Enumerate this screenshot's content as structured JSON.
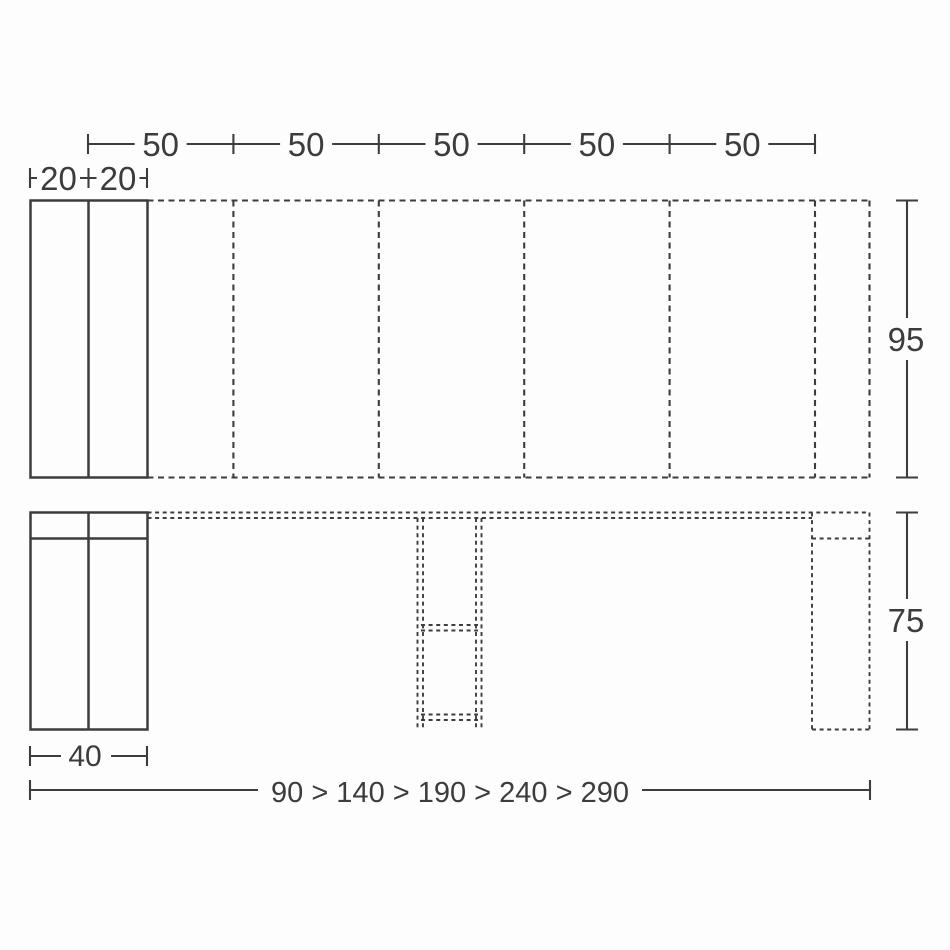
{
  "colors": {
    "background": "#fdfdfd",
    "line": "#3d3d3d",
    "text": "#3c3c3c"
  },
  "top_view": {
    "segment_labels": [
      "50",
      "50",
      "50",
      "50",
      "50"
    ],
    "panel_labels": [
      "20",
      "20"
    ],
    "depth_label": "95"
  },
  "front_view": {
    "height_label": "75",
    "base_width_label": "40",
    "length_sequence_label": "90 > 140 > 190 > 240 > 290"
  }
}
